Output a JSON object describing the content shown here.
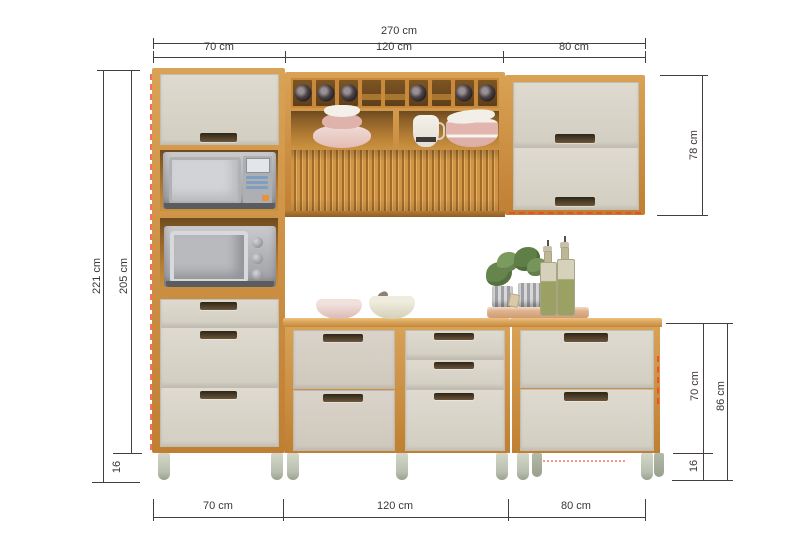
{
  "dims": {
    "top_total": "270 cm",
    "top_segments": [
      "70 cm",
      "120 cm",
      "80 cm"
    ],
    "bottom_segments": [
      "70 cm",
      "120 cm",
      "80 cm"
    ],
    "left_total": "221 cm",
    "left_body": "205 cm",
    "left_feet": "16",
    "right_upper": "78 cm",
    "right_base_body": "70 cm",
    "right_base_total": "86 cm",
    "right_feet": "16"
  },
  "colors": {
    "wood": "#c8893e",
    "wood_dark": "#9c6a2c",
    "front_cream": "#d9d5ca",
    "dimension_line": "#453e3e",
    "label_text": "#3b3636",
    "feet": "#c5cbb9",
    "red_marker": "#f33f26"
  }
}
